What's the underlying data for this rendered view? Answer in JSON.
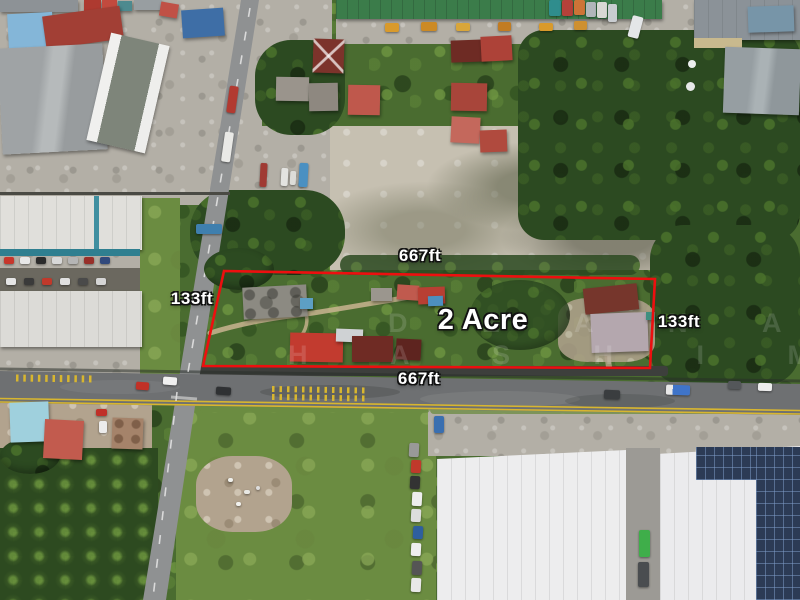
{
  "annotations": {
    "area_label": "2 Acre",
    "top_length_label": "667ft",
    "bottom_length_label": "667ft",
    "left_width_label": "133ft",
    "right_width_label": "133ft",
    "boundary_color": "#ed0f0f",
    "boundary_points": "224,271 655,279 650,368 203,366"
  },
  "watermark": {
    "line1": "D Z A N A W",
    "line2": "H A S H I M"
  }
}
